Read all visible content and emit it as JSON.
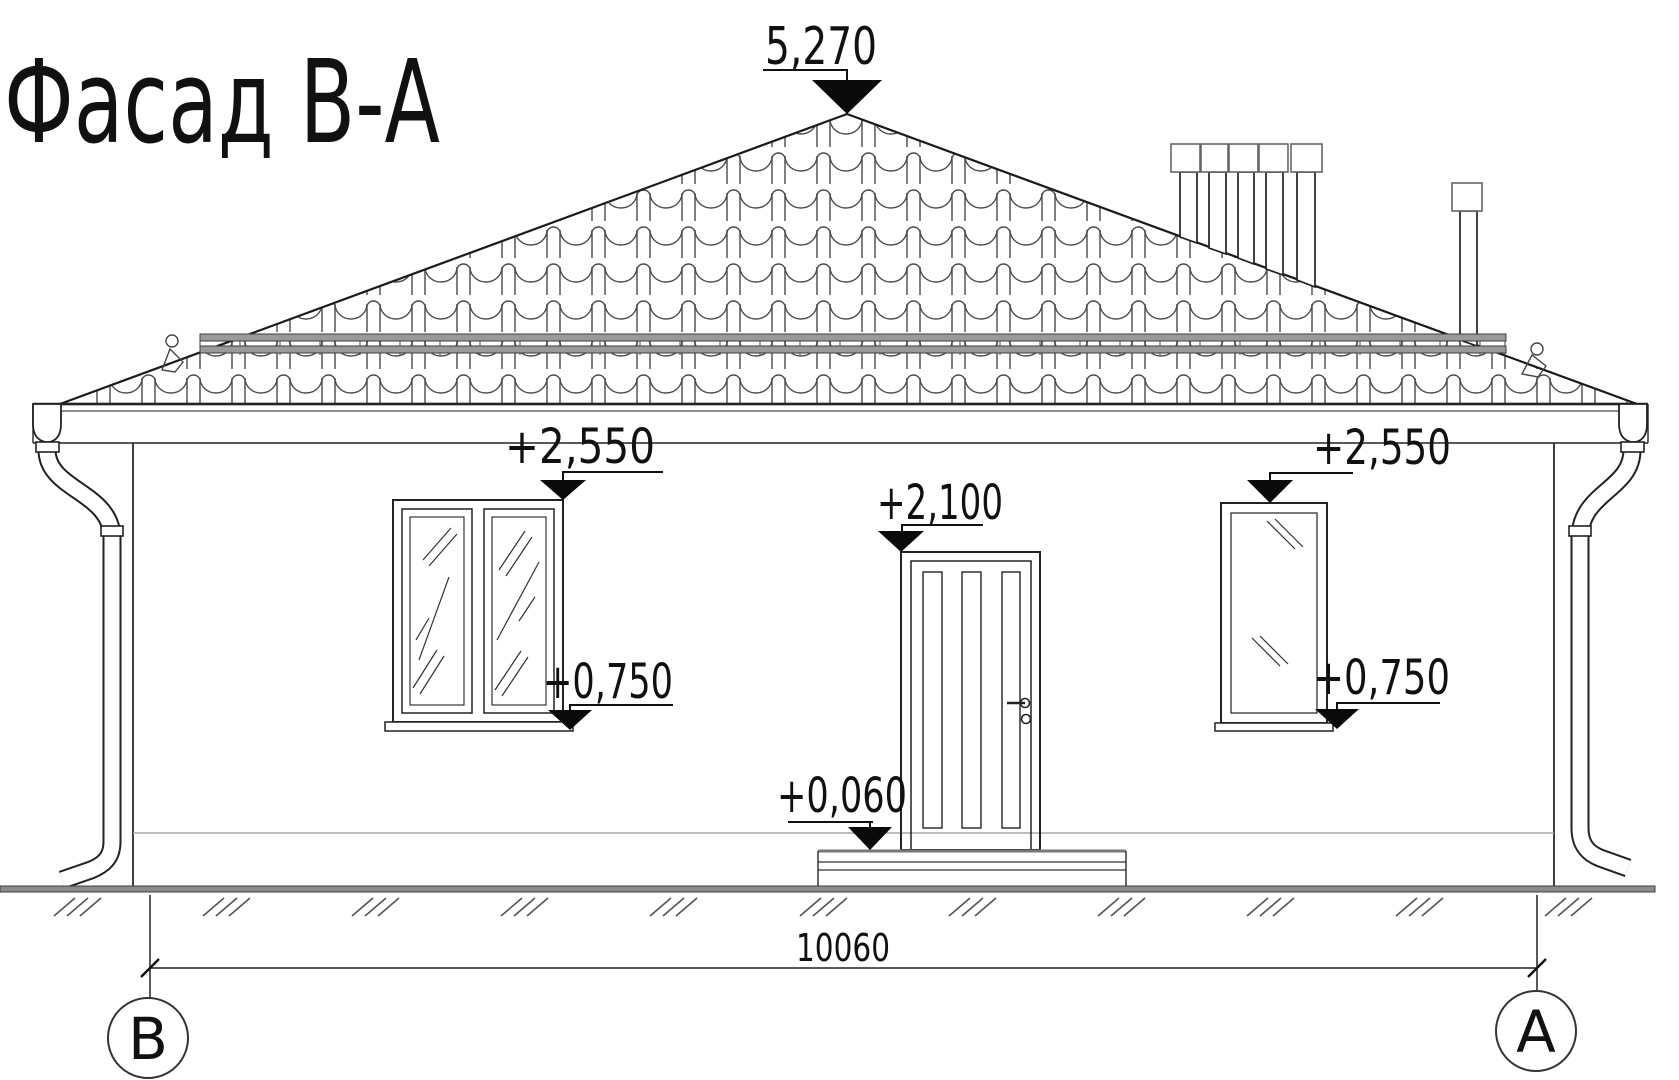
{
  "title": "Фасад В-А",
  "levels": {
    "ridge": "5,270",
    "left_window_head": "+2,550",
    "right_window_head": "+2,550",
    "door_head": "+2,100",
    "left_window_sill": "+0,750",
    "right_window_sill": "+0,750",
    "porch": "+0,060"
  },
  "dimension": {
    "overall": "10060"
  },
  "axes": {
    "left": "В",
    "right": "А"
  },
  "colors": {
    "ink": "#1a1a1a",
    "tile_line": "#4a4a4a",
    "snow_rail": "#9a9a9a",
    "ground_band": "#8a8a8a"
  }
}
